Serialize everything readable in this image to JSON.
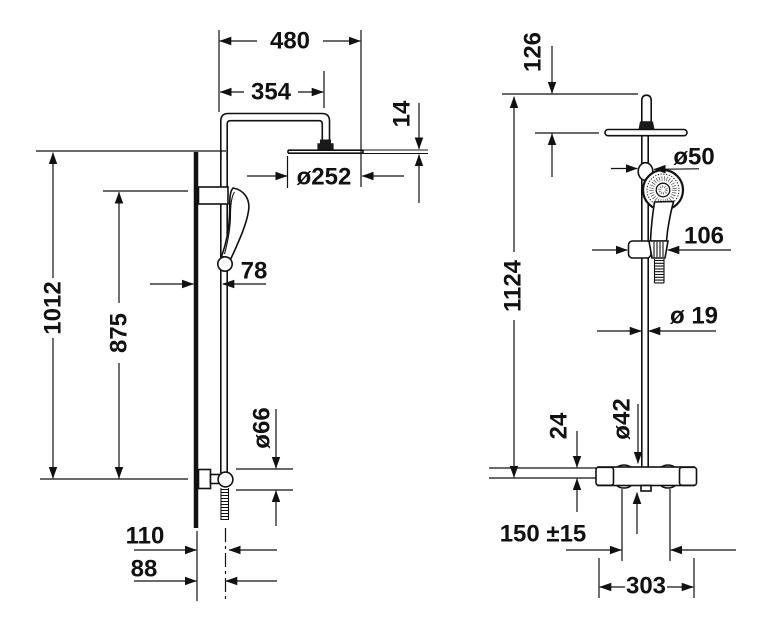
{
  "page": {
    "background": "#ffffff",
    "line_color": "#111111",
    "text_color": "#111111"
  },
  "drawing": {
    "views": {
      "side_view": {
        "dimensions": {
          "arm_reach": "480",
          "head_center_offset": "354",
          "head_plate_thickness": "14",
          "head_diameter": "ø252",
          "wall_bar_height": "1012",
          "bracket_spacing": "875",
          "rail_wall_distance": "78",
          "bracket_diameter": "ø66",
          "hose_wall_distance_outer": "110",
          "hose_wall_distance_inner": "88"
        }
      },
      "front_view": {
        "dimensions": {
          "head_below_top": "126",
          "slider_knob_diameter": "ø50",
          "holder_width": "106",
          "total_height": "1124",
          "pipe_diameter": "ø 19",
          "valve_center_to_top": "24",
          "valve_body_diameter": "ø42",
          "inlet_spacing": "150 ±15",
          "valve_overall_width": "303"
        }
      }
    }
  }
}
